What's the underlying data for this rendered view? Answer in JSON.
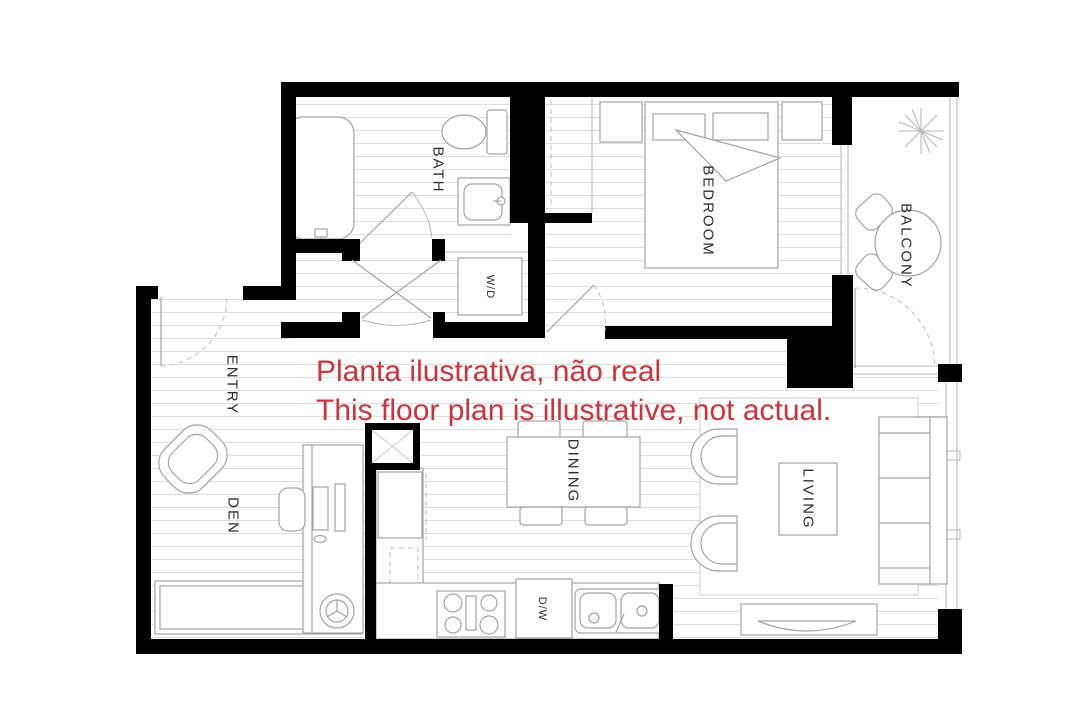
{
  "disclaimer": {
    "line1": "Planta ilustrativa, não real",
    "line2": "This floor plan is illustrative, not actual.",
    "color": "#c8353c"
  },
  "rooms": {
    "bath": "BATH",
    "bedroom": "BEDROOM",
    "balcony": "BALCONY",
    "entry": "ENTRY",
    "den": "DEN",
    "dining": "DINING",
    "living": "LIVING"
  },
  "appliances": {
    "washer_dryer": "W/D",
    "dishwasher": "D/W"
  },
  "colors": {
    "background": "#ffffff",
    "wall": "#000000",
    "furniture_line": "#a3a3a3",
    "floor_hatch": "#dedede",
    "label": "#2e2e2e",
    "disclaimer_red": "#c8353c"
  }
}
